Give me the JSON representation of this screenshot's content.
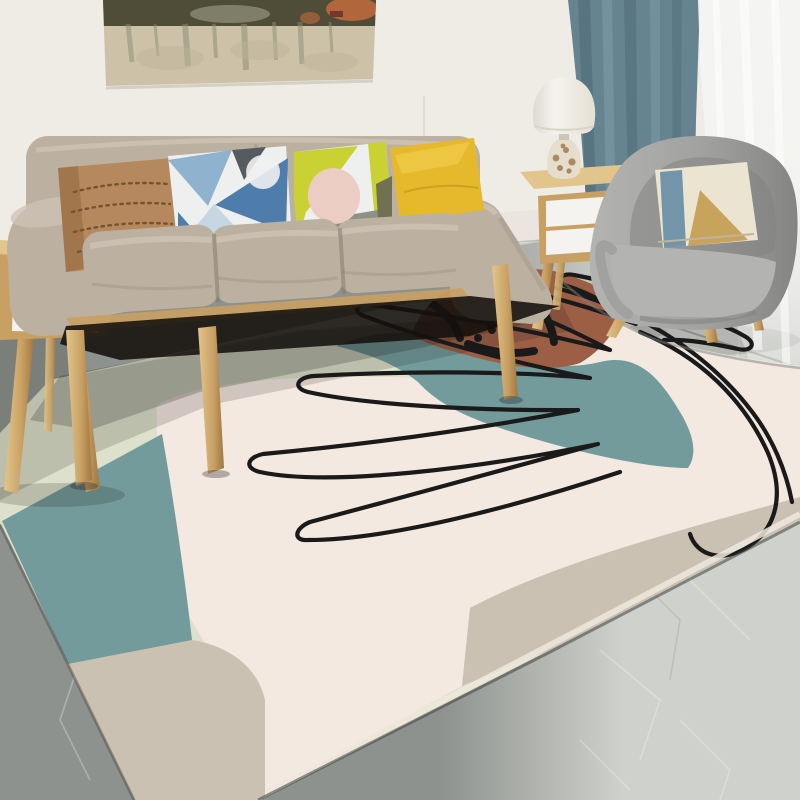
{
  "meta": {
    "title": "Scandinavian living room with abstract monstera line-art area rug",
    "visible_text": "",
    "camera": "interior product photo, slight right-side perspective"
  },
  "palette": {
    "wall": "#efece6",
    "wallLow": "#e5e1d8",
    "paintBase": "#cdc1a8",
    "paintWash": "#bfb49a",
    "paintDark": "#4f4c37",
    "paintRust": "#b2663c",
    "paintGreen": "#8b8c74",
    "boat": "#74382a",
    "curtain": "#66848f",
    "curtainDark": "#54707c",
    "curtainLight": "#7b98a2",
    "floorL": "#8e928e",
    "floorR": "#cfd1cc",
    "seam": "#60645f",
    "woodL": "#e2c58c",
    "wood": "#c9a063",
    "woodD": "#9e7843",
    "sofa": "#bcb0a1",
    "sofaL": "#cdc3b5",
    "sofaD": "#a2968a",
    "sofaDeep": "#7c7165",
    "tan": "#b5895d",
    "tanDot": "#77522e",
    "blueA": "#4e7dac",
    "blueB": "#8fb2cf",
    "blueC": "#c6d6e3",
    "slate": "#565b60",
    "offwhite": "#eef0ef",
    "chartreuse": "#c9d232",
    "blush": "#eccdc4",
    "grayband": "#8e9184",
    "olive": "#6f7152",
    "mustard": "#e5b92b",
    "mustardL": "#f1cc4d",
    "chair": "#a1a19f",
    "chairD": "#848482",
    "chairL": "#b3b3b1",
    "cpCream": "#ebe4d1",
    "cpBlue": "#7295a9",
    "cpTan": "#c7a35b",
    "shade": "#f5f3ed",
    "glass": "#e6ddcc",
    "shell": "#a88a63",
    "drawer": "#f4f3ef",
    "knob": "#caa84e",
    "rugGreen": "#dde1cb",
    "rugTeal": "#739b9c",
    "rugCream": "#f3e9e1",
    "rugCreamD": "#e9dcd3",
    "rugTaupe": "#cbc1b3",
    "rugRust": "#9c5f46",
    "ink": "#1a1a1a"
  },
  "objects": {
    "wall_art": {
      "label": "abstract watercolor landscape painting, top edge cropped"
    },
    "drape_curtain": {
      "label": "teal blue drape curtain"
    },
    "sheer_curtain": {
      "label": "white sheer curtain pooling at right"
    },
    "sofa": {
      "label": "three-seat beige fabric sofa with tapered wood legs"
    },
    "sofa_pillows": [
      {
        "label": "tan pillow with dotted weave pattern"
      },
      {
        "label": "blue geometric triangle pillow"
      },
      {
        "label": "chartreuse, white, blush and gray geometric pillow"
      },
      {
        "label": "solid mustard yellow pillow"
      }
    ],
    "armchair": {
      "label": "gray fabric barrel armchair with wood legs"
    },
    "armchair_pillow": {
      "label": "cream pillow with blue band and tan triangle"
    },
    "side_table_left": {
      "label": "wood nightstand with white drawers, partially cropped"
    },
    "side_table_right": {
      "label": "wood nightstand with two white drawers and brass knobs"
    },
    "table_lamp": {
      "label": "lamp with white bell shade and shell-filled glass base"
    },
    "floor": {
      "label": "gray marble tile floor"
    },
    "rug": {
      "label": "abstract area rug shown in perspective",
      "motifs": [
        "pale sage field",
        "teal arc band and teal blob",
        "large blush cream organic shape",
        "taupe crescent areas",
        "terracotta corner patch with bold black foliage strokes",
        "black one-line monstera leaf drawing"
      ]
    }
  }
}
